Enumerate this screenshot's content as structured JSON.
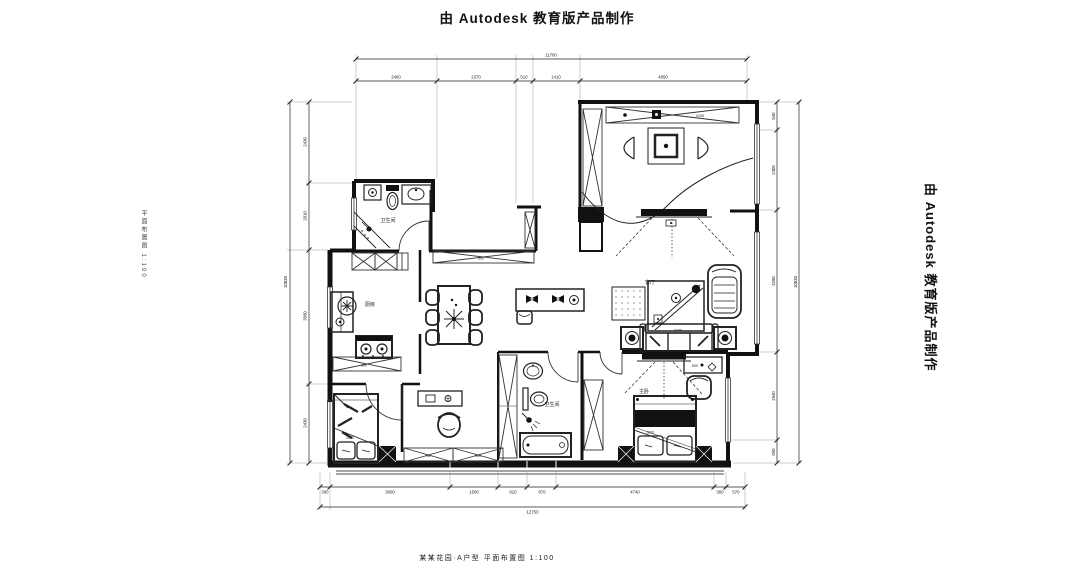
{
  "watermarks": {
    "top": "由 Autodesk 教育版产品制作",
    "right": "由 Autodesk 教育版产品制作",
    "bottom": "某某花园·A户型 平面布置图 1:100",
    "left": "平面布置图 1:100"
  },
  "rooms": {
    "bath1": "卫生间",
    "kitchen": "厨房",
    "living": "客厅",
    "bath2": "卫生间",
    "bedroom2": "主卧"
  },
  "marks": {
    "corridor_cabinet": "350",
    "kitchen_counter": "600",
    "study_cabinet_left": "780",
    "study_cabinet_right": "900",
    "top_cabinet": "4150",
    "bed1": "1500",
    "bed2": "1800",
    "sofa": "2400",
    "dresser": "600"
  },
  "dims": {
    "top": {
      "overall": "11700",
      "segments": [
        "2460",
        "2370",
        "510",
        "1410",
        "4950"
      ]
    },
    "bottom": {
      "overall": "12750",
      "segments": [
        "300",
        "3600",
        "1500",
        "810",
        "870",
        "4740",
        "360",
        "570"
      ]
    },
    "left": {
      "overall": "10830",
      "segments": [
        "2430",
        "2010",
        "3960",
        "2430"
      ]
    },
    "right": {
      "overall": "10830",
      "segments": [
        "840",
        "2400",
        "4260",
        "2640",
        "690"
      ]
    }
  },
  "colors": {
    "ink": "#1a1a1a",
    "paper": "#ffffff"
  }
}
